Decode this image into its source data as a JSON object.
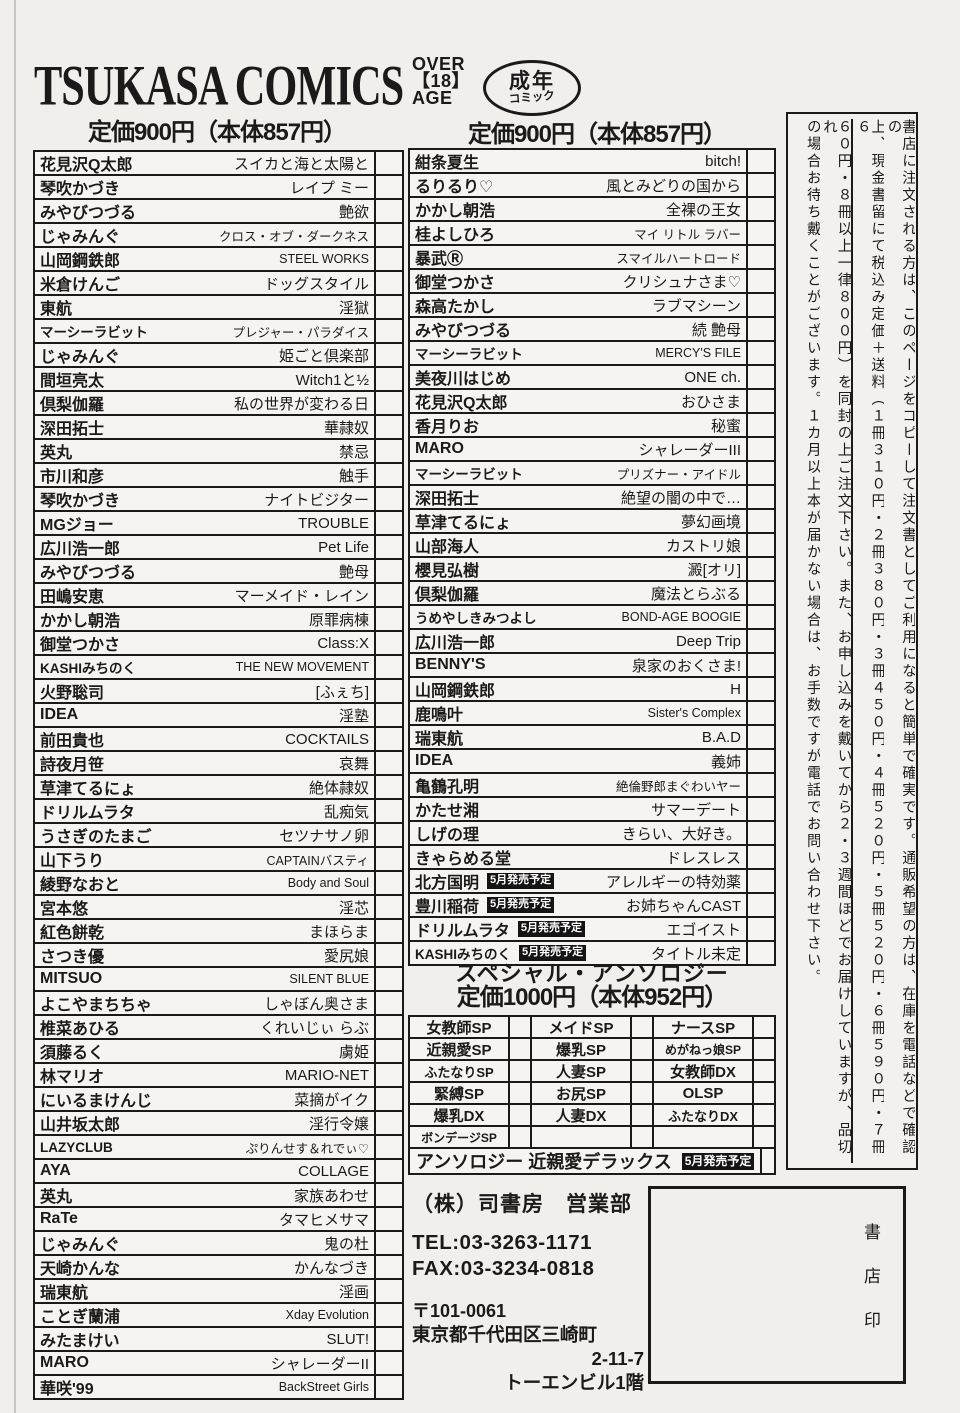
{
  "header": {
    "logo": "TSUKASA COMICS",
    "age_badge": {
      "line1": "OVER",
      "line2": "【18】",
      "line3": "AGE"
    },
    "adult_badge": {
      "line1": "成年",
      "line2": "コミック"
    },
    "price_left": "定価900円（本体857円）",
    "price_right": "定価900円（本体857円）"
  },
  "left_table": {
    "rows": [
      {
        "author": "花見沢Q太郎",
        "title": "スイカと海と太陽と"
      },
      {
        "author": "琴吹かづき",
        "title": "レイプ ミー"
      },
      {
        "author": "みやびつづる",
        "title": "艶欲"
      },
      {
        "author": "じゃみんぐ",
        "title": "クロス・オブ・ダークネス"
      },
      {
        "author": "山岡鋼鉄郎",
        "title": "STEEL WORKS"
      },
      {
        "author": "米倉けんご",
        "title": "ドッグスタイル"
      },
      {
        "author": "東航",
        "title": "淫獄"
      },
      {
        "author": "マーシーラビット",
        "title": "プレジャー・パラダイス"
      },
      {
        "author": "じゃみんぐ",
        "title": "姫ごと倶楽部"
      },
      {
        "author": "間垣亮太",
        "title": "Witch1と½"
      },
      {
        "author": "倶梨伽羅",
        "title": "私の世界が変わる日"
      },
      {
        "author": "深田拓士",
        "title": "華隷奴"
      },
      {
        "author": "英丸",
        "title": "禁忌"
      },
      {
        "author": "市川和彦",
        "title": "触手"
      },
      {
        "author": "琴吹かづき",
        "title": "ナイトビジター"
      },
      {
        "author": "MGジョー",
        "title": "TROUBLE"
      },
      {
        "author": "広川浩一郎",
        "title": "Pet Life"
      },
      {
        "author": "みやびつづる",
        "title": "艶母"
      },
      {
        "author": "田嶋安恵",
        "title": "マーメイド・レイン"
      },
      {
        "author": "かかし朝浩",
        "title": "原罪病棟"
      },
      {
        "author": "御堂つかさ",
        "title": "Class:X"
      },
      {
        "author": "KASHIみちのく",
        "title": "THE NEW MOVEMENT"
      },
      {
        "author": "火野聡司",
        "title": "[ふぇち]"
      },
      {
        "author": "IDEA",
        "title": "淫塾"
      },
      {
        "author": "前田貴也",
        "title": "COCKTAILS"
      },
      {
        "author": "詩夜月笹",
        "title": "哀舞"
      },
      {
        "author": "草津てるにょ",
        "title": "絶体隷奴"
      },
      {
        "author": "ドリルムラタ",
        "title": "乱痴気"
      },
      {
        "author": "うさぎのたまご",
        "title": "セツナサノ卵"
      },
      {
        "author": "山下うり",
        "title": "CAPTAINバスティ"
      },
      {
        "author": "綾野なおと",
        "title": "Body and Soul"
      },
      {
        "author": "宮本悠",
        "title": "淫芯"
      },
      {
        "author": "紅色餅乾",
        "title": "まほらま"
      },
      {
        "author": "さつき優",
        "title": "愛尻娘"
      },
      {
        "author": "MITSUO",
        "title": "SILENT BLUE"
      },
      {
        "author": "よこやまちちゃ",
        "title": "しゃぼん奥さま"
      },
      {
        "author": "椎菜あひる",
        "title": "くれいじぃ らぶ"
      },
      {
        "author": "須藤るく",
        "title": "虜姫"
      },
      {
        "author": "林マリオ",
        "title": "MARIO-NET"
      },
      {
        "author": "にいるまけんじ",
        "title": "菜摘がイク"
      },
      {
        "author": "山井坂太郎",
        "title": "淫行令嬢"
      },
      {
        "author": "LAZYCLUB",
        "title": "ぷりんせす＆れでぃ♡"
      },
      {
        "author": "AYA",
        "title": "COLLAGE"
      },
      {
        "author": "英丸",
        "title": "家族あわせ"
      },
      {
        "author": "RaTe",
        "title": "タマヒメサマ"
      },
      {
        "author": "じゃみんぐ",
        "title": "鬼の杜"
      },
      {
        "author": "天崎かんな",
        "title": "かんなづき"
      },
      {
        "author": "瑞東航",
        "title": "淫画"
      },
      {
        "author": "ことぎ蘭浦",
        "title": "Xday Evolution"
      },
      {
        "author": "みたまけい",
        "title": "SLUT!"
      },
      {
        "author": "MARO",
        "title": "シャレーダーII"
      },
      {
        "author": "華咲'99",
        "title": "BackStreet Girls"
      }
    ]
  },
  "right_table": {
    "rows": [
      {
        "author": "紺条夏生",
        "title": "bitch!"
      },
      {
        "author": "るりるり♡",
        "title": "風とみどりの国から"
      },
      {
        "author": "かかし朝浩",
        "title": "全裸の王女"
      },
      {
        "author": "桂よしひろ",
        "title": "マイ リトル ラバー"
      },
      {
        "author": "暴武Ⓡ",
        "title": "スマイルハートロード"
      },
      {
        "author": "御堂つかさ",
        "title": "クリシュナさま♡"
      },
      {
        "author": "森高たかし",
        "title": "ラブマシーン"
      },
      {
        "author": "みやびつづる",
        "title": "続 艶母"
      },
      {
        "author": "マーシーラビット",
        "title": "MERCY'S FILE"
      },
      {
        "author": "美夜川はじめ",
        "title": "ONE ch."
      },
      {
        "author": "花見沢Q太郎",
        "title": "おひさま"
      },
      {
        "author": "香月りお",
        "title": "秘蜜"
      },
      {
        "author": "MARO",
        "title": "シャレーダーIII"
      },
      {
        "author": "マーシーラビット",
        "title": "プリズナー・アイドル"
      },
      {
        "author": "深田拓士",
        "title": "絶望の闇の中で…"
      },
      {
        "author": "草津てるにょ",
        "title": "夢幻画境"
      },
      {
        "author": "山部海人",
        "title": "カストリ娘"
      },
      {
        "author": "櫻見弘樹",
        "title": "澱[オリ]"
      },
      {
        "author": "倶梨伽羅",
        "title": "魔法とらぶる"
      },
      {
        "author": "うめやしきみつよし",
        "title": "BOND-AGE BOOGIE"
      },
      {
        "author": "広川浩一郎",
        "title": "Deep Trip"
      },
      {
        "author": "BENNY'S",
        "title": "泉家のおくさま!"
      },
      {
        "author": "山岡鋼鉄郎",
        "title": "H"
      },
      {
        "author": "鹿鳴叶",
        "title": "Sister's Complex"
      },
      {
        "author": "瑞東航",
        "title": "B.A.D"
      },
      {
        "author": "IDEA",
        "title": "義姉"
      },
      {
        "author": "亀鶴孔明",
        "title": "絶倫野郎まぐわいヤー"
      },
      {
        "author": "かたせ湘",
        "title": "サマーデート"
      },
      {
        "author": "しげの理",
        "title": "きらい、大好き。"
      },
      {
        "author": "きゃらめる堂",
        "title": "ドレスレス"
      },
      {
        "author": "北方国明",
        "badge": "5月発売予定",
        "title": "アレルギーの特効薬"
      },
      {
        "author": "豊川稲荷",
        "badge": "5月発売予定",
        "title": "お姉ちゃんCAST"
      },
      {
        "author": "ドリルムラタ",
        "badge": "5月発売予定",
        "title": "エゴイスト"
      },
      {
        "author": "KASHIみちのく",
        "badge": "5月発売予定",
        "title": "タイトル未定"
      }
    ]
  },
  "anthology": {
    "title": "スペシャル・アンソロジー",
    "price": "定価1000円（本体952円）",
    "grid": [
      [
        "女教師SP",
        "メイドSP",
        "ナースSP"
      ],
      [
        "近親愛SP",
        "爆乳SP",
        "めがねっ娘SP"
      ],
      [
        "ふたなりSP",
        "人妻SP",
        "女教師DX"
      ],
      [
        "緊縛SP",
        "お尻SP",
        "OLSP"
      ],
      [
        "爆乳DX",
        "人妻DX",
        "ふたなりDX"
      ],
      [
        "ボンデージSP",
        "",
        ""
      ]
    ],
    "deluxe_row": {
      "label": "アンソロジー 近親愛デラックス",
      "badge": "5月発売予定"
    }
  },
  "publisher": {
    "name": "（株）司書房　営業部",
    "tel": "TEL:03-3263-1171",
    "fax": "FAX:03-3234-0818",
    "postal": "〒101-0061",
    "address1": "東京都千代田区三崎町",
    "address2": "2-11-7",
    "address3": "トーエンビル1階"
  },
  "stamp_box": {
    "label": "書店印"
  },
  "order_note": {
    "columns": [
      "書店に注文される方は、このページをコピーして注文書としてご利用になると簡単で確実です。通販希望の方は、在庫を電話などで確認の",
      "上、現金書留にて税込み定価＋送料（１冊３１０円・２冊３８０円・３冊４５０円・４冊５２０円・５冊５２０円・６冊５９０円・７冊６",
      "６０円・８冊以上一律８００円）を同封の上ご注文下さい。また、お申し込みを戴いてから２・３週間ほどでお届けしていますが、品切れ",
      "の場合お待ち戴くことがございます。１カ月以上本が届かない場合は、お手数ですが電話でお問い合わせ下さい。"
    ]
  }
}
